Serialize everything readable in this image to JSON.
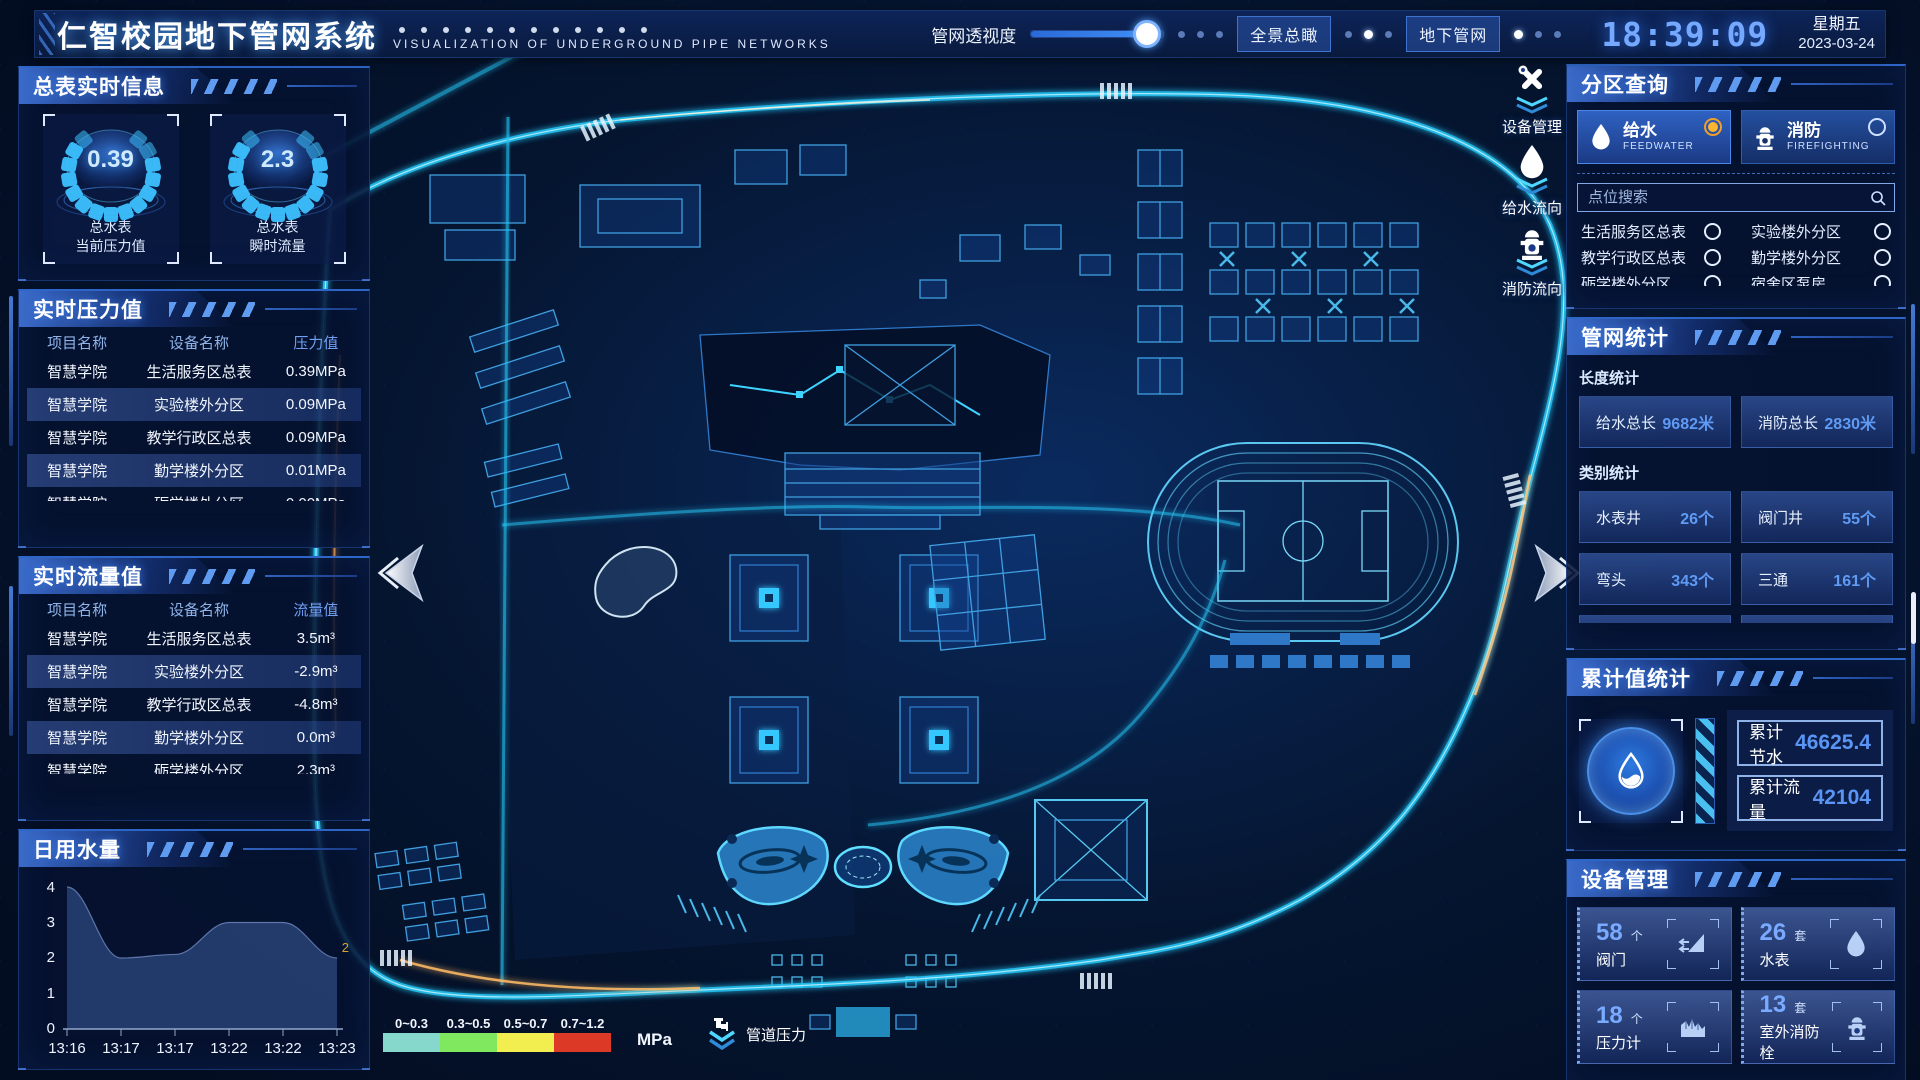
{
  "header": {
    "title": "仁智校园地下管网系统",
    "subtitle": "VISUALIZATION OF UNDERGROUND PIPE NETWORKS",
    "slider_label": "管网透视度",
    "btn_overview": "全景总瞰",
    "btn_underground": "地下管网",
    "time": "18:39:09",
    "weekday": "星期五",
    "date": "2023-03-24"
  },
  "left_panel": {
    "meter": {
      "title": "总表实时信息",
      "gauges": [
        {
          "value": "0.39",
          "line1": "总水表",
          "line2": "当前压力值"
        },
        {
          "value": "2.3",
          "line1": "总水表",
          "line2": "瞬时流量"
        }
      ]
    },
    "pressure": {
      "title": "实时压力值",
      "headers": [
        "项目名称",
        "设备名称",
        "压力值"
      ],
      "rows": [
        [
          "智慧学院",
          "生活服务区总表",
          "0.39MPa"
        ],
        [
          "智慧学院",
          "实验楼外分区",
          "0.09MPa"
        ],
        [
          "智慧学院",
          "教学行政区总表",
          "0.09MPa"
        ],
        [
          "智慧学院",
          "勤学楼外分区",
          "0.01MPa"
        ],
        [
          "智慧学院",
          "砺学楼外分区",
          "0.00MPa"
        ]
      ]
    },
    "flow": {
      "title": "实时流量值",
      "headers": [
        "项目名称",
        "设备名称",
        "流量值"
      ],
      "rows": [
        [
          "智慧学院",
          "生活服务区总表",
          "3.5m³"
        ],
        [
          "智慧学院",
          "实验楼外分区",
          "-2.9m³"
        ],
        [
          "智慧学院",
          "教学行政区总表",
          "-4.8m³"
        ],
        [
          "智慧学院",
          "勤学楼外分区",
          "0.0m³"
        ],
        [
          "智慧学院",
          "砺学楼外分区",
          "2.3m³"
        ]
      ]
    },
    "daily": {
      "title": "日用水量"
    }
  },
  "chart_data": {
    "type": "area",
    "title": "日用水量",
    "x": [
      "13:16",
      "13:17",
      "13:17",
      "13:22",
      "13:22",
      "13:23"
    ],
    "values": [
      4,
      2,
      2.1,
      3,
      3,
      2
    ],
    "ylim": [
      0,
      4
    ],
    "yticks": [
      "4",
      "3",
      "2",
      "1",
      "0"
    ],
    "end_label": "2",
    "area_color": "#3b5c9c",
    "end_label_color": "#d9a62a"
  },
  "map": {
    "toolbar": [
      {
        "icon": "wrench-icon",
        "label": "设备管理"
      },
      {
        "icon": "water-drop-icon",
        "label": "给水流向"
      },
      {
        "icon": "hydrant-icon",
        "label": "消防流向"
      }
    ],
    "legend": {
      "title": "管道压力",
      "unit": "MPa",
      "ranges": [
        {
          "label": "0~0.3",
          "color": "#85d8cb"
        },
        {
          "label": "0.3~0.5",
          "color": "#7fe85e"
        },
        {
          "label": "0.5~0.7",
          "color": "#f2ee4f"
        },
        {
          "label": "0.7~1.2",
          "color": "#dc3a26"
        }
      ]
    }
  },
  "right_panel": {
    "zone": {
      "title": "分区查询",
      "tabs": [
        {
          "label": "给水",
          "sub": "FEEDWATER"
        },
        {
          "label": "消防",
          "sub": "FIREFIGHTING"
        }
      ],
      "search_placeholder": "点位搜索",
      "items": [
        "生活服务区总表",
        "实验楼外分区",
        "教学行政区总表",
        "勤学楼外分区",
        "砺学楼外分区",
        "宿舍区泵房"
      ]
    },
    "stats": {
      "title": "管网统计",
      "length_label": "长度统计",
      "length_items": [
        {
          "label": "给水总长",
          "value": "9682米"
        },
        {
          "label": "消防总长",
          "value": "2830米"
        }
      ],
      "category_label": "类别统计",
      "category_items": [
        {
          "label": "水表井",
          "value": "26个"
        },
        {
          "label": "阀门井",
          "value": "55个"
        },
        {
          "label": "弯头",
          "value": "343个"
        },
        {
          "label": "三通",
          "value": "161个"
        }
      ]
    },
    "cumulative": {
      "title": "累计值统计",
      "items": [
        {
          "label": "累计节水",
          "value": "46625.4"
        },
        {
          "label": "累计流量",
          "value": "42104"
        }
      ]
    },
    "devices": {
      "title": "设备管理",
      "cards": [
        {
          "count": "58",
          "unit": "个",
          "label": "阀门",
          "icon": "valve-icon"
        },
        {
          "count": "26",
          "unit": "套",
          "label": "水表",
          "icon": "water-meter-icon"
        },
        {
          "count": "18",
          "unit": "个",
          "label": "压力计",
          "icon": "pressure-gauge-icon"
        },
        {
          "count": "13",
          "unit": "套",
          "label": "室外消防栓",
          "icon": "outdoor-hydrant-icon"
        }
      ]
    }
  }
}
